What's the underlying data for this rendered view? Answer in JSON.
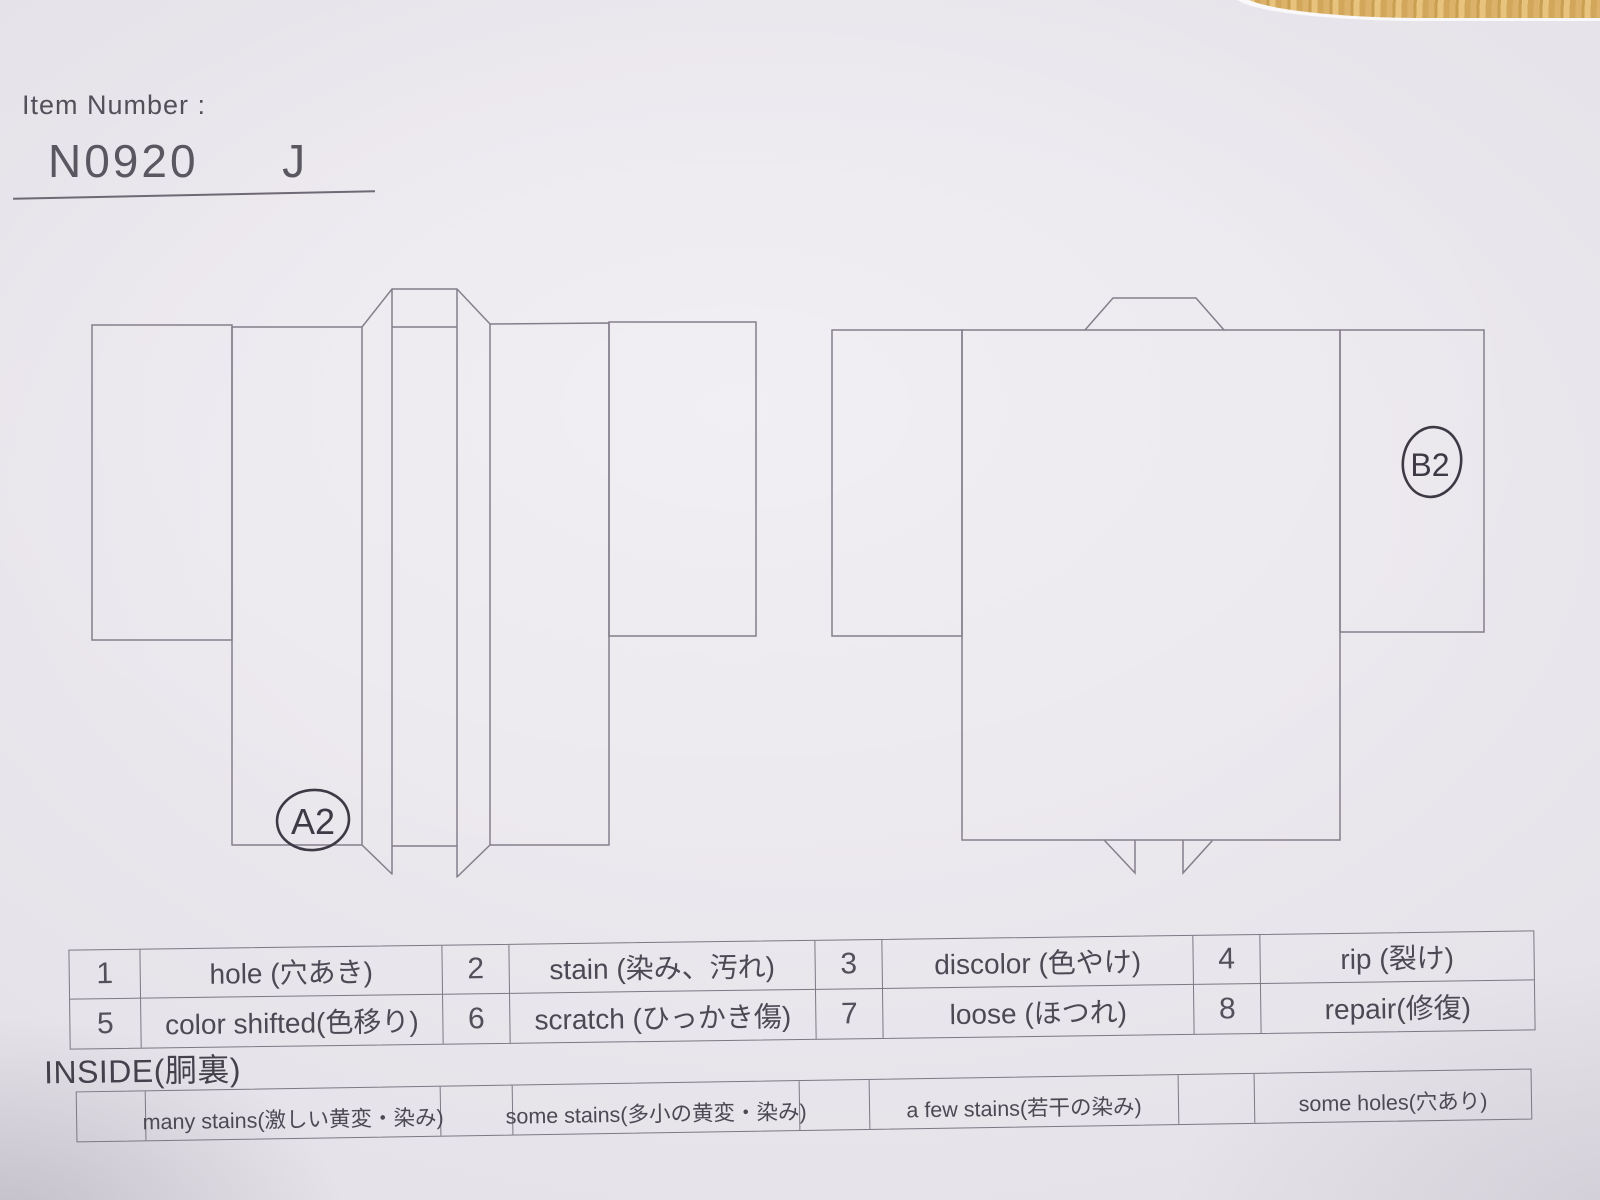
{
  "header": {
    "item_number_label": "Item Number :",
    "item_number_value": "N0920  J"
  },
  "diagrams": {
    "front": {
      "annotation": "A2"
    },
    "back": {
      "annotation": "B2"
    }
  },
  "defect_table": {
    "rows": [
      {
        "cells": [
          {
            "num": "1",
            "label": "hole (穴あき)"
          },
          {
            "num": "2",
            "label": "stain (染み、汚れ)"
          },
          {
            "num": "3",
            "label": "discolor (色やけ)"
          },
          {
            "num": "4",
            "label": "rip (裂け)"
          }
        ]
      },
      {
        "cells": [
          {
            "num": "5",
            "label": "color shifted(色移り)"
          },
          {
            "num": "6",
            "label": "scratch (ひっかき傷)"
          },
          {
            "num": "7",
            "label": "loose (ほつれ)"
          },
          {
            "num": "8",
            "label": "repair(修復)"
          }
        ]
      }
    ]
  },
  "inside": {
    "title": "INSIDE(胴裏)",
    "cells": [
      {
        "label": "many stains(激しい黄変・染み)"
      },
      {
        "label": "some stains(多小の黄変・染み)"
      },
      {
        "label": "a few stains(若干の染み)"
      },
      {
        "label": "some holes(穴あり)"
      }
    ]
  },
  "colors": {
    "paper": "#e8e5eb",
    "line": "#7d7884",
    "ink": "#4d4954",
    "handwriting": "#3e3a45",
    "wood": "#d6ab61"
  }
}
